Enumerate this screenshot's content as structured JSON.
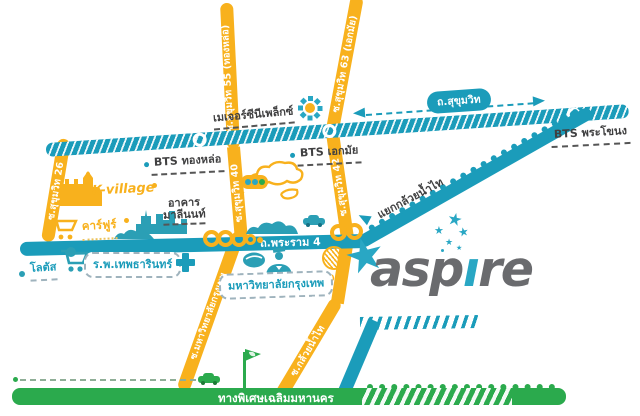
{
  "colors": {
    "teal": "#1b9cba",
    "yellow": "#f8b11d",
    "green": "#2baa4d",
    "logo_gray": "#6a6b6e",
    "label_dark": "#404041"
  },
  "roads": {
    "sukhumvit_direction": "ถ.สุขุมวิท",
    "soi_26": "ซ.สุขุมวิท 26",
    "soi_55": "ซ.สุขุมวิท 55 (ทองหล่อ)",
    "soi_40": "ซ.สุขุมวิท 40",
    "soi_63": "ซ.สุขุมวิท 63 (เอกมัย)",
    "soi_42": "ซ.สุขุมวิท 42",
    "rama4": "ถ.พระราม 4",
    "soi_bangkok_university": "ซ.มหาวิทยาลัยกรุงเทพ",
    "soi_kluai_nam_thai": "ซ.กล้วยน้ำไท",
    "expressway": "ทางพิเศษเฉลิมมหานคร",
    "kluai_nam_thai_junction": "แยกกล้วยน้ำไท"
  },
  "stations": [
    {
      "name": "BTS ทองหล่อ"
    },
    {
      "name": "BTS เอกมัย"
    },
    {
      "name": "BTS พระโขนง"
    }
  ],
  "places": {
    "major_cineplex": "เมเจอร์ซีนีเพล็กซ์",
    "k_village": "K-village",
    "carrefour": "คาร์ฟูร์",
    "lotus": "โลตัส",
    "theptarin_hospital": "ร.พ.เทพธารินทร์",
    "maleenont_line1": "อาคาร",
    "maleenont_line2": "มาลีนนท์",
    "bangkok_university": "มหาวิทยาลัยกรุงเทพ"
  },
  "logo": {
    "start": "asp",
    "i": "ı",
    "end": "re"
  },
  "icons": {
    "star": "★"
  }
}
